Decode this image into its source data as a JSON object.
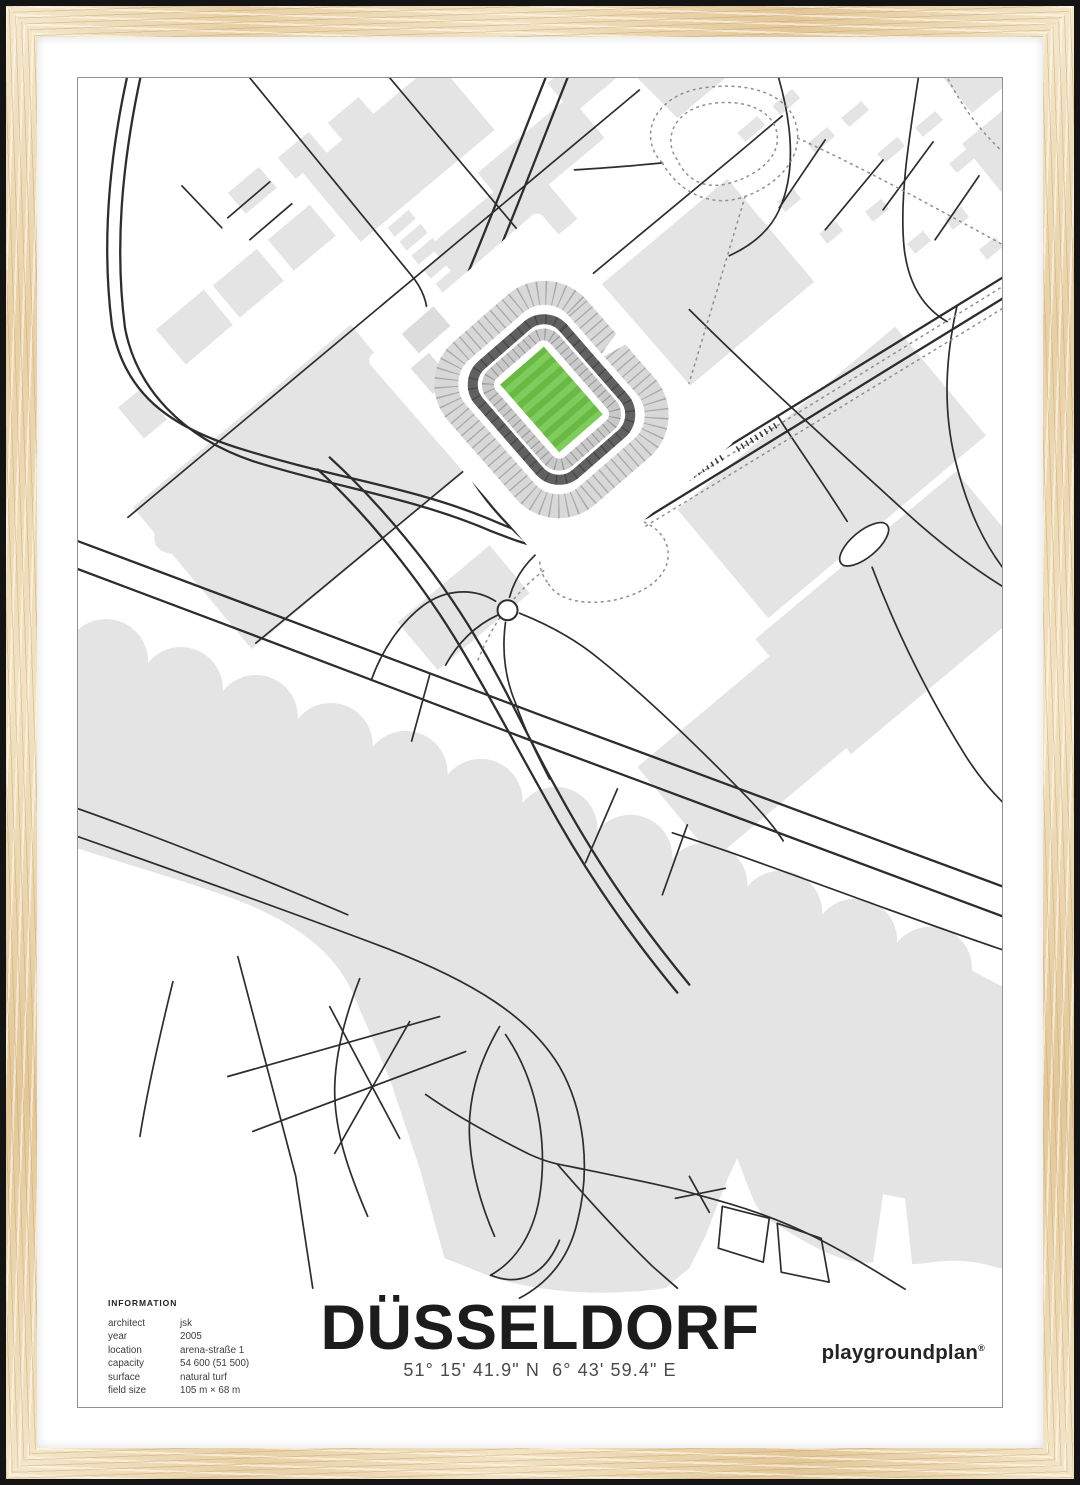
{
  "poster": {
    "title": "DÜSSELDORF",
    "coordinates": "51° 15' 41.9\" N  6° 43' 59.4\" E",
    "brand": {
      "name": "playgroundplan",
      "mark": "®"
    },
    "information": {
      "heading": "INFORMATION",
      "rows": [
        {
          "label": "architect",
          "value": "jsk"
        },
        {
          "label": "year",
          "value": "2005"
        },
        {
          "label": "location",
          "value": "arena-straße 1"
        },
        {
          "label": "capacity",
          "value": "54 600 (51 500)"
        },
        {
          "label": "surface",
          "value": "natural turf"
        },
        {
          "label": "field size",
          "value": "105 m × 68 m"
        }
      ]
    },
    "map": {
      "colors": {
        "pitch_green": "#6ab944",
        "pitch_green_light": "#7fcb5e",
        "block_gray": "#e4e4e4",
        "road_black": "#2d2d2d",
        "tram_gray": "#8f8f8f",
        "frame_wood": "#ecd9b8",
        "mat_white": "#ffffff"
      }
    }
  }
}
